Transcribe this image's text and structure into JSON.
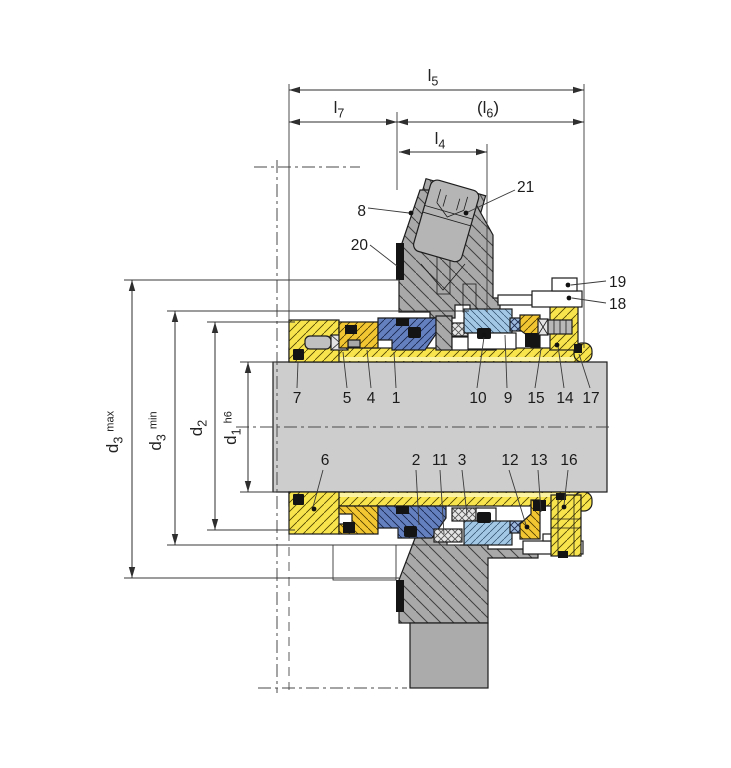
{
  "figure": {
    "kind": "engineering cross-section drawing",
    "subject": "cartridge mechanical shaft seal with gland, sleeve and seal faces",
    "background": "#ffffff"
  },
  "dimension_labels": {
    "l5": {
      "base": "l",
      "sub": "5"
    },
    "l7": {
      "base": "l",
      "sub": "7"
    },
    "l6": {
      "open": "(",
      "base": "l",
      "sub": "6",
      "close": ")"
    },
    "l4": {
      "base": "l",
      "sub": "4"
    },
    "d3max": {
      "base": "d",
      "sub": "3",
      "qualifier": "max"
    },
    "d3min": {
      "base": "d",
      "sub": "3",
      "qualifier": "min"
    },
    "d2": {
      "base": "d",
      "sub": "2"
    },
    "d1": {
      "base": "d",
      "sub": "1",
      "qualifier": "h6"
    }
  },
  "part_labels": [
    "1",
    "2",
    "3",
    "4",
    "5",
    "6",
    "7",
    "8",
    "9",
    "10",
    "11",
    "12",
    "13",
    "14",
    "15",
    "16",
    "17",
    "18",
    "19",
    "20",
    "21"
  ],
  "colors": {
    "housing_gray": "#a9a9a9",
    "solid_gray": "#ababab",
    "shaft_gray": "#cdcdcd",
    "sleeve_yellow": "#f8e44c",
    "thrust_orange": "#f2c632",
    "rotating_face_blue": "#6480bf",
    "stationary_face_blue": "#a3c8e6",
    "elastomer_black": "#141414",
    "spring_gray": "#e8e8e8",
    "line_dark": "#1c1c1c"
  }
}
